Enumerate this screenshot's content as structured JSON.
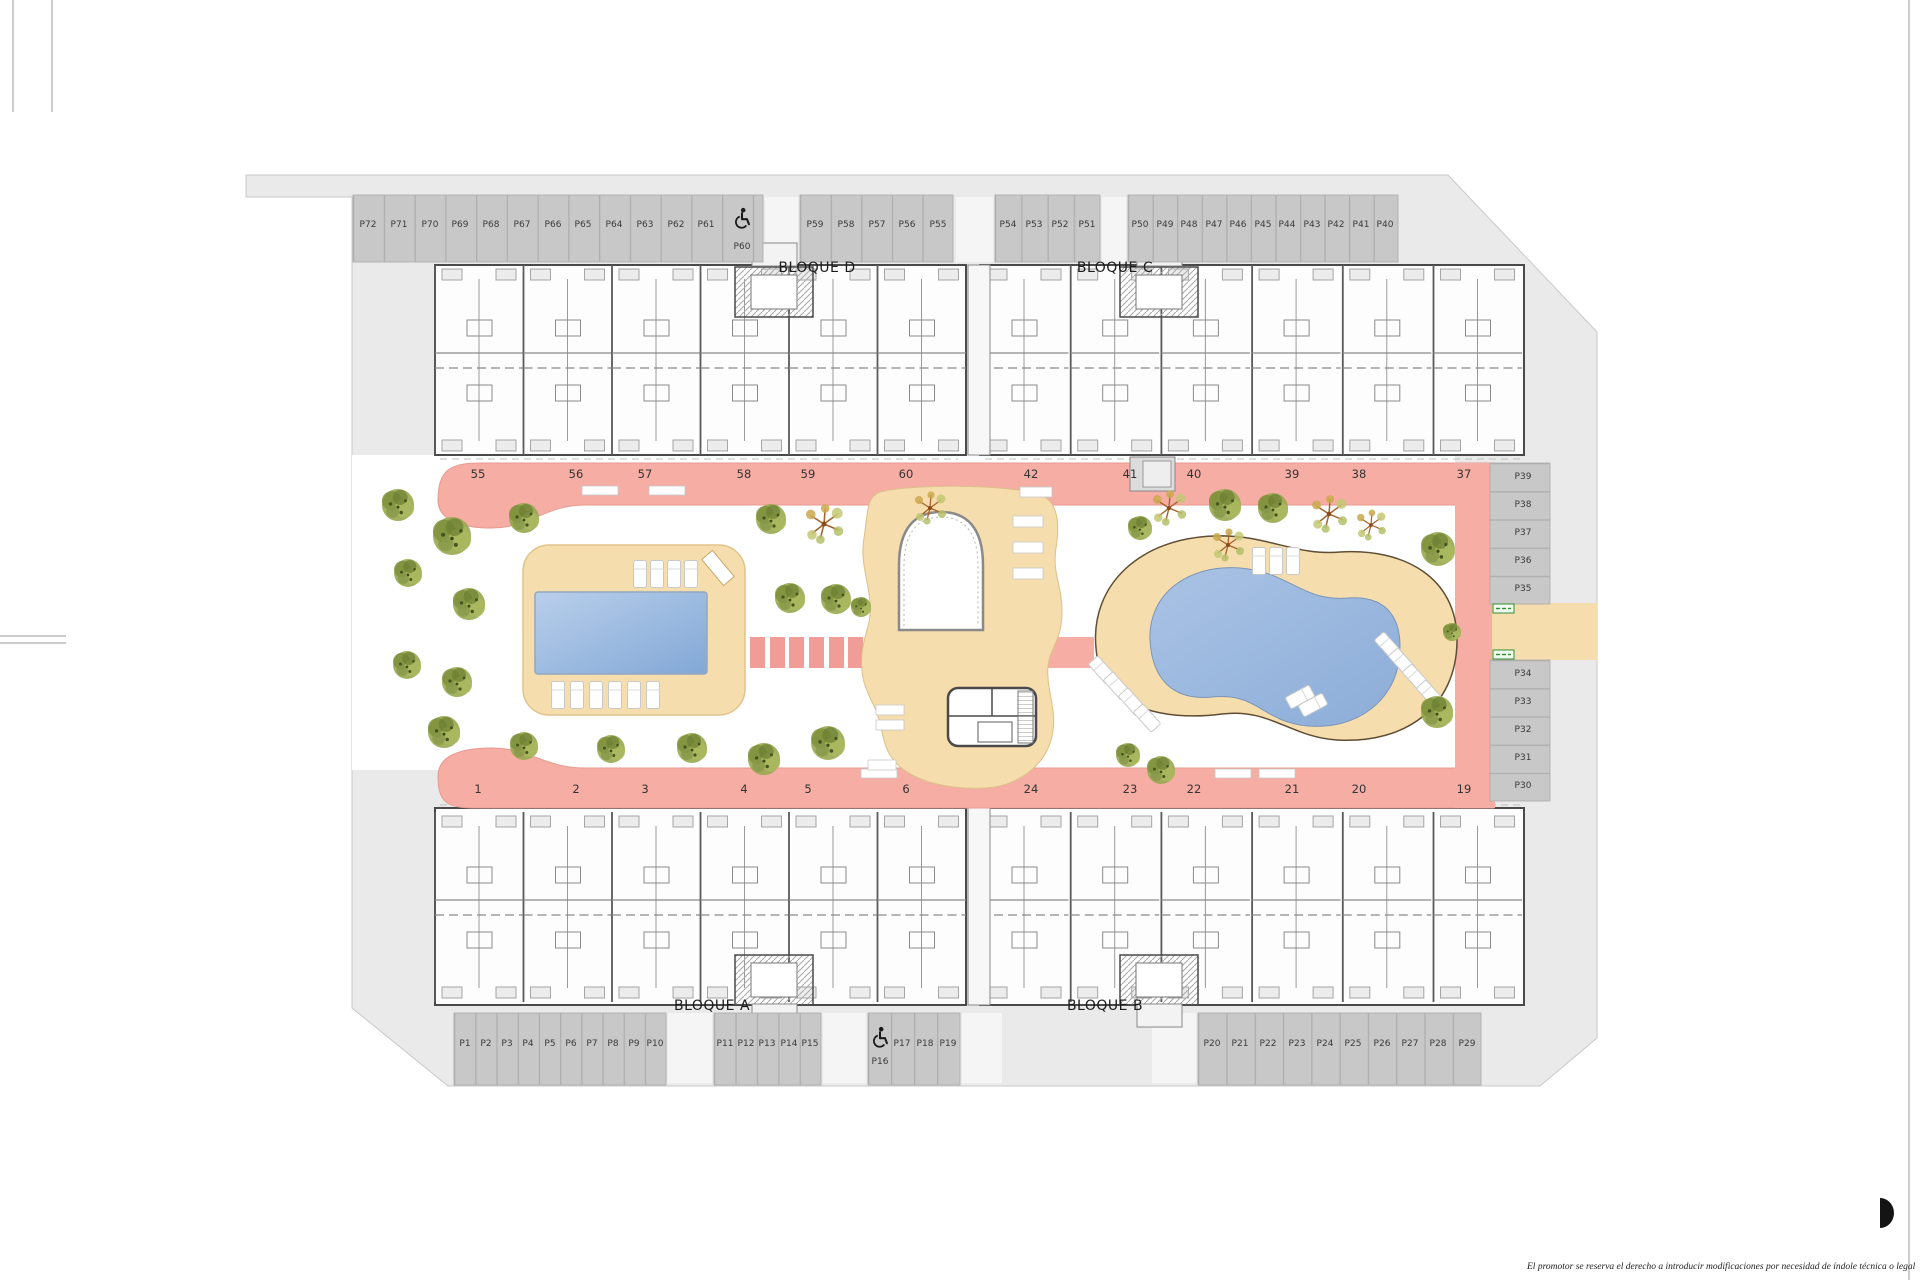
{
  "plan": {
    "blocks": {
      "a": "BLOQUE A",
      "b": "BLOQUE B",
      "c": "BLOQUE C",
      "d": "BLOQUE D"
    },
    "unit_numbers": {
      "top": [
        "55",
        "56",
        "57",
        "58",
        "59",
        "60",
        "42",
        "41",
        "40",
        "39",
        "38",
        "37"
      ],
      "bottom": [
        "1",
        "2",
        "3",
        "4",
        "5",
        "6",
        "24",
        "23",
        "22",
        "21",
        "20",
        "19"
      ]
    },
    "parking": {
      "top": {
        "group1": [
          "P72",
          "P71",
          "P70",
          "P69",
          "P68",
          "P67",
          "P66",
          "P65",
          "P64",
          "P63",
          "P62",
          "P61"
        ],
        "accessible": "P60",
        "group2": [
          "P59",
          "P58",
          "P57",
          "P56",
          "P55"
        ],
        "group3": [
          "P54",
          "P53",
          "P52",
          "P51"
        ],
        "group4": [
          "P50",
          "P49",
          "P48",
          "P47",
          "P46",
          "P45",
          "P44",
          "P43",
          "P42",
          "P41",
          "P40"
        ]
      },
      "right": {
        "group1": [
          "P39",
          "P38",
          "P37",
          "P36",
          "P35"
        ],
        "group2": [
          "P34",
          "P33",
          "P32",
          "P31",
          "P30"
        ]
      },
      "bottom": {
        "group1": [
          "P1",
          "P2",
          "P3",
          "P4",
          "P5",
          "P6",
          "P7",
          "P8",
          "P9",
          "P10"
        ],
        "group2": [
          "P11",
          "P12",
          "P13",
          "P14",
          "P15"
        ],
        "accessible": "P16",
        "group3": [
          "P17",
          "P18",
          "P19"
        ],
        "group4": [
          "P20",
          "P21",
          "P22",
          "P23",
          "P24",
          "P25",
          "P26",
          "P27",
          "P28",
          "P29"
        ]
      }
    },
    "icons": {
      "accessible_parking": "wheelchair-icon",
      "exit_sign": "green-exit-sign"
    },
    "colors": {
      "walkway_pink": "#f5ada4",
      "deck_beige": "#f5ddad",
      "pool_blue": "#9cb8de",
      "site_gray": "#eaeaea",
      "stall_gray": "#c8c8c8",
      "tree_green": "#97a84f",
      "sign_green": "#2f8f2f"
    },
    "footer": {
      "disclaimer": "El promotor se reserva el derecho a introducir modificaciones por necesidad de índole técnica o legal"
    }
  }
}
